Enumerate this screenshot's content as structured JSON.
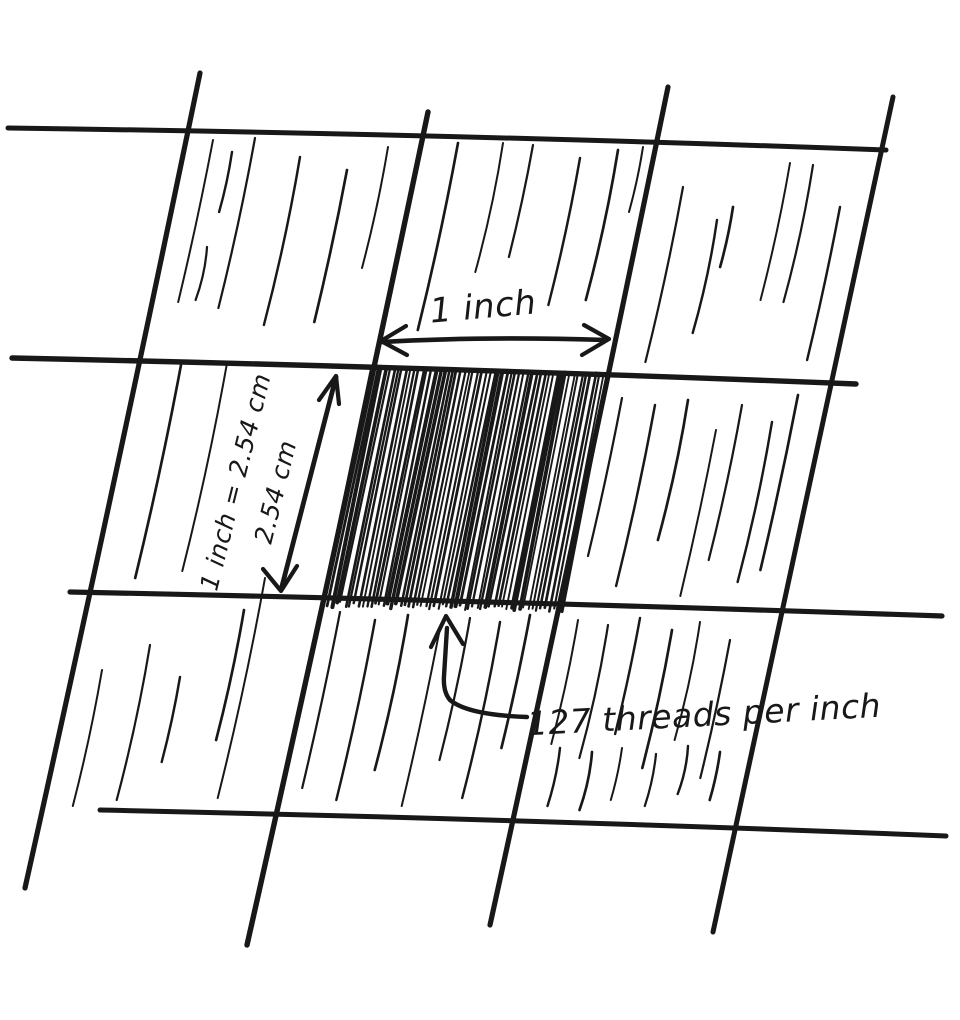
{
  "canvas": {
    "background": "#ffffff",
    "ink": "#181818"
  },
  "annotations": {
    "width_label": "1 inch",
    "height_label": "1 inch = 2.54 cm",
    "height_sublabel": "2.54 cm",
    "threads_label": "127 threads per inch"
  },
  "values": {
    "inch_in_cm": "2.54",
    "threads_per_inch": "127"
  }
}
